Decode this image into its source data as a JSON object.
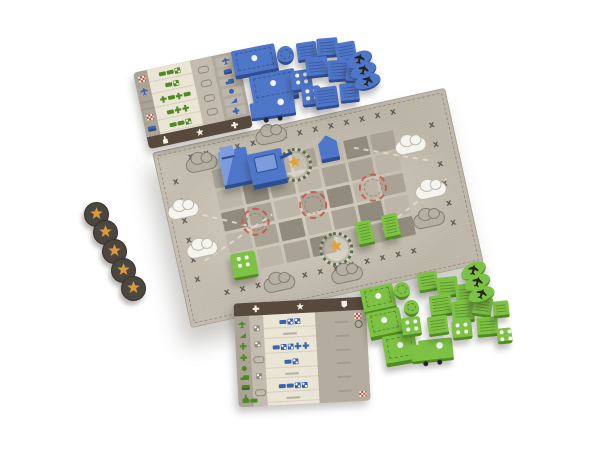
{
  "scene": {
    "description": "Product photo of a tabletop war game: cloth battle mat with stitched grid, blue and green wooden army pieces, star tokens and two player-aid cards on a white background",
    "background": "#ffffff"
  },
  "palette": {
    "mat_base": "#bdb6a9",
    "mat_edge": "#a79f92",
    "cell_light": "#bcb5a8",
    "cell_mid": "#a9a295",
    "cell_dark": "#918b7e",
    "stitch_dark": "#49453d",
    "stitch_light": "#e2dbc9",
    "target_red": "#c4584b",
    "wreath_green": "#5c6b49",
    "star_gold": "#e2a23b",
    "cloud_white": "#f6f4ee",
    "cloud_grey": "#b6b0a4",
    "blue_main": "#4f77c9",
    "blue_dark": "#2d4e91",
    "green_main": "#7dc244",
    "green_dark": "#4f8c21",
    "token_dark": "#4b463f",
    "token_star": "#d9993c",
    "card_grey": "#aaa396",
    "card_cream": "#ebe5d5",
    "card_bar": "#57493c"
  },
  "mat": {
    "x": 168,
    "y": 118,
    "w": 300,
    "h": 180,
    "rot": -12.5,
    "stitch": {
      "glyph": "x",
      "top": 14,
      "bottom": 13,
      "left": 6,
      "right": 6
    },
    "grid": {
      "x": 54,
      "y": 30,
      "cols": 7,
      "rows": 5,
      "cell_w": 24,
      "cell_h": 19,
      "gap": 3,
      "cells": [
        1,
        0,
        2,
        1,
        0,
        2,
        1,
        0,
        2,
        1,
        0,
        1,
        1,
        0,
        2,
        1,
        0,
        1,
        2,
        0,
        1,
        0,
        1,
        2,
        0,
        1,
        2,
        0,
        1,
        0,
        1,
        2,
        0,
        1,
        2
      ]
    },
    "targets": [
      {
        "x": 72,
        "y": 76
      },
      {
        "x": 132,
        "y": 72
      },
      {
        "x": 194,
        "y": 68
      }
    ],
    "wreaths": [
      {
        "x": 120,
        "y": 26
      },
      {
        "x": 142,
        "y": 117
      }
    ],
    "clouds_white": [
      {
        "x": 2,
        "y": 56
      },
      {
        "x": 12,
        "y": 98
      },
      {
        "x": 238,
        "y": 42
      },
      {
        "x": 248,
        "y": 90
      }
    ],
    "clouds_grey": [
      {
        "x": 104,
        "y": 2
      },
      {
        "x": 30,
        "y": 14
      },
      {
        "x": 80,
        "y": 148
      },
      {
        "x": 148,
        "y": 154
      },
      {
        "x": 240,
        "y": 118
      }
    ],
    "paths": [
      {
        "x": 18,
        "y": 62,
        "len": 72,
        "rot": 26
      },
      {
        "x": 28,
        "y": 116,
        "len": 82,
        "rot": -22
      },
      {
        "x": 198,
        "y": 38,
        "len": 80,
        "rot": 22
      },
      {
        "x": 208,
        "y": 124,
        "len": 82,
        "rot": -26
      }
    ]
  },
  "pieces": {
    "blue": [
      {
        "t": "block",
        "x": 233,
        "y": 47,
        "w": 44,
        "h": 25,
        "r": -11
      },
      {
        "t": "block",
        "x": 251,
        "y": 72,
        "w": 46,
        "h": 27,
        "r": -11
      },
      {
        "t": "truck",
        "x": 259,
        "y": 96,
        "w": 36,
        "h": 19,
        "r": -8
      },
      {
        "t": "cyl",
        "x": 277,
        "y": 46,
        "w": 17,
        "h": 16,
        "r": 0
      },
      {
        "t": "die",
        "x": 291,
        "y": 70,
        "w": 21,
        "h": 19,
        "r": -8
      },
      {
        "t": "die",
        "x": 302,
        "y": 86,
        "w": 19,
        "h": 18,
        "r": -6
      },
      {
        "t": "chunk",
        "x": 297,
        "y": 42,
        "w": 20,
        "h": 17,
        "r": -8
      },
      {
        "t": "chunk",
        "x": 317,
        "y": 38,
        "w": 21,
        "h": 17,
        "r": -5
      },
      {
        "t": "chunk",
        "x": 336,
        "y": 42,
        "w": 20,
        "h": 17,
        "r": -10
      },
      {
        "t": "chunk",
        "x": 306,
        "y": 57,
        "w": 22,
        "h": 18,
        "r": -6
      },
      {
        "t": "chunk",
        "x": 328,
        "y": 60,
        "w": 22,
        "h": 19,
        "r": -4
      },
      {
        "t": "chunk",
        "x": 346,
        "y": 64,
        "w": 15,
        "h": 17,
        "r": 6
      },
      {
        "t": "chunk",
        "x": 315,
        "y": 87,
        "w": 23,
        "h": 19,
        "r": -8
      },
      {
        "t": "chunk",
        "x": 340,
        "y": 83,
        "w": 19,
        "h": 17,
        "r": -6
      },
      {
        "t": "oval",
        "x": 346,
        "y": 52,
        "w": 27,
        "h": 14,
        "r": -28
      },
      {
        "t": "oval",
        "x": 350,
        "y": 63,
        "w": 27,
        "h": 14,
        "r": -24
      },
      {
        "t": "oval",
        "x": 354,
        "y": 74,
        "w": 27,
        "h": 14,
        "r": -20
      },
      {
        "t": "step",
        "x": 221,
        "y": 149,
        "w": 29,
        "h": 34,
        "r": -12
      },
      {
        "t": "tank",
        "x": 250,
        "y": 151,
        "w": 35,
        "h": 31,
        "r": -12
      },
      {
        "t": "flag",
        "x": 319,
        "y": 135,
        "w": 19,
        "h": 23,
        "r": -12
      }
    ],
    "green": [
      {
        "t": "block",
        "x": 362,
        "y": 286,
        "w": 33,
        "h": 23,
        "r": -12
      },
      {
        "t": "block",
        "x": 368,
        "y": 310,
        "w": 34,
        "h": 24,
        "r": -12
      },
      {
        "t": "block",
        "x": 384,
        "y": 334,
        "w": 33,
        "h": 27,
        "r": -10
      },
      {
        "t": "cyl",
        "x": 394,
        "y": 282,
        "w": 16,
        "h": 15,
        "r": 0
      },
      {
        "t": "cyl",
        "x": 404,
        "y": 300,
        "w": 15,
        "h": 14,
        "r": 0
      },
      {
        "t": "die",
        "x": 402,
        "y": 317,
        "w": 19,
        "h": 17,
        "r": -8
      },
      {
        "t": "truck",
        "x": 419,
        "y": 339,
        "w": 34,
        "h": 20,
        "r": -6
      },
      {
        "t": "chunk",
        "x": 418,
        "y": 272,
        "w": 20,
        "h": 17,
        "r": -10
      },
      {
        "t": "chunk",
        "x": 437,
        "y": 277,
        "w": 21,
        "h": 18,
        "r": -6
      },
      {
        "t": "chunk",
        "x": 456,
        "y": 284,
        "w": 21,
        "h": 18,
        "r": -4
      },
      {
        "t": "chunk",
        "x": 430,
        "y": 295,
        "w": 22,
        "h": 19,
        "r": -8
      },
      {
        "t": "chunk",
        "x": 452,
        "y": 301,
        "w": 22,
        "h": 19,
        "r": -5
      },
      {
        "t": "chunk",
        "x": 473,
        "y": 297,
        "w": 19,
        "h": 17,
        "r": 8
      },
      {
        "t": "die",
        "x": 452,
        "y": 320,
        "w": 20,
        "h": 17,
        "r": -6
      },
      {
        "t": "chunk",
        "x": 428,
        "y": 316,
        "w": 20,
        "h": 17,
        "r": -8
      },
      {
        "t": "chunk",
        "x": 477,
        "y": 317,
        "w": 21,
        "h": 17,
        "r": -5
      },
      {
        "t": "chunk",
        "x": 493,
        "y": 301,
        "w": 16,
        "h": 14,
        "r": -6
      },
      {
        "t": "die",
        "x": 497,
        "y": 328,
        "w": 15,
        "h": 13,
        "r": -6
      },
      {
        "t": "oval",
        "x": 460,
        "y": 263,
        "w": 27,
        "h": 14,
        "r": -30
      },
      {
        "t": "oval",
        "x": 464,
        "y": 275,
        "w": 27,
        "h": 14,
        "r": -25
      },
      {
        "t": "oval",
        "x": 468,
        "y": 287,
        "w": 27,
        "h": 14,
        "r": -20
      },
      {
        "t": "chunk",
        "x": 357,
        "y": 221,
        "w": 16,
        "h": 22,
        "r": -12
      },
      {
        "t": "chunk",
        "x": 383,
        "y": 214,
        "w": 16,
        "h": 22,
        "r": -12
      },
      {
        "t": "die",
        "x": 232,
        "y": 252,
        "w": 25,
        "h": 24,
        "r": -10
      }
    ]
  },
  "tokens": {
    "star": [
      {
        "x": 84,
        "y": 202
      },
      {
        "x": 93,
        "y": 220
      },
      {
        "x": 102,
        "y": 239
      },
      {
        "x": 111,
        "y": 258
      },
      {
        "x": 121,
        "y": 276
      }
    ]
  },
  "cards": {
    "top_card": {
      "left_icons": [
        {
          "n": "checker",
          "c": "red"
        },
        {
          "n": "plane",
          "c": "blue"
        },
        {
          "n": "dash",
          "c": "grey"
        },
        {
          "n": "dash",
          "c": "grey"
        },
        {
          "n": "checker",
          "c": "red"
        },
        {
          "n": "tank",
          "c": "blue"
        }
      ],
      "center_rows": [
        [
          "bar",
          "bar",
          "die"
        ],
        [
          "bar",
          "die"
        ],
        [
          "cross",
          "bar",
          "cross",
          "bar"
        ],
        [
          "bar",
          "cross",
          "cross"
        ],
        [
          "bar",
          "bar",
          "die"
        ]
      ],
      "chain_icons": [
        "chain",
        "chain",
        "chain",
        "chain"
      ],
      "unit_icons": [
        "plane",
        "tank",
        "truck",
        "infantry",
        "artillery",
        "cross"
      ],
      "footer_icons": [
        "meeple",
        "star",
        "cross"
      ]
    },
    "bottom_card": {
      "header_icons": [
        "cross",
        "star",
        "badge"
      ],
      "left_icons": [
        "plane",
        "artillery",
        "cross",
        "cross",
        "infantry",
        "truck",
        "tank",
        "meeple"
      ],
      "mid_icons": [
        "die",
        "die",
        "chain",
        "die",
        "chain"
      ],
      "center_rows": [
        [
          "bar",
          "die",
          "die"
        ],
        [
          "dash"
        ],
        [
          "bar",
          "die",
          "die",
          "cross",
          "cross"
        ],
        [
          "bar",
          "die"
        ],
        [
          "dash"
        ],
        [
          "bar",
          "bar",
          "die",
          "die"
        ],
        [
          "dash"
        ]
      ],
      "right_dash_rows": 6,
      "corner_icons": {
        "top_right": [
          "checker",
          "wreath"
        ],
        "bottom_right": [
          "checker"
        ],
        "bottom_left": [
          "bar",
          "bar"
        ]
      }
    }
  }
}
